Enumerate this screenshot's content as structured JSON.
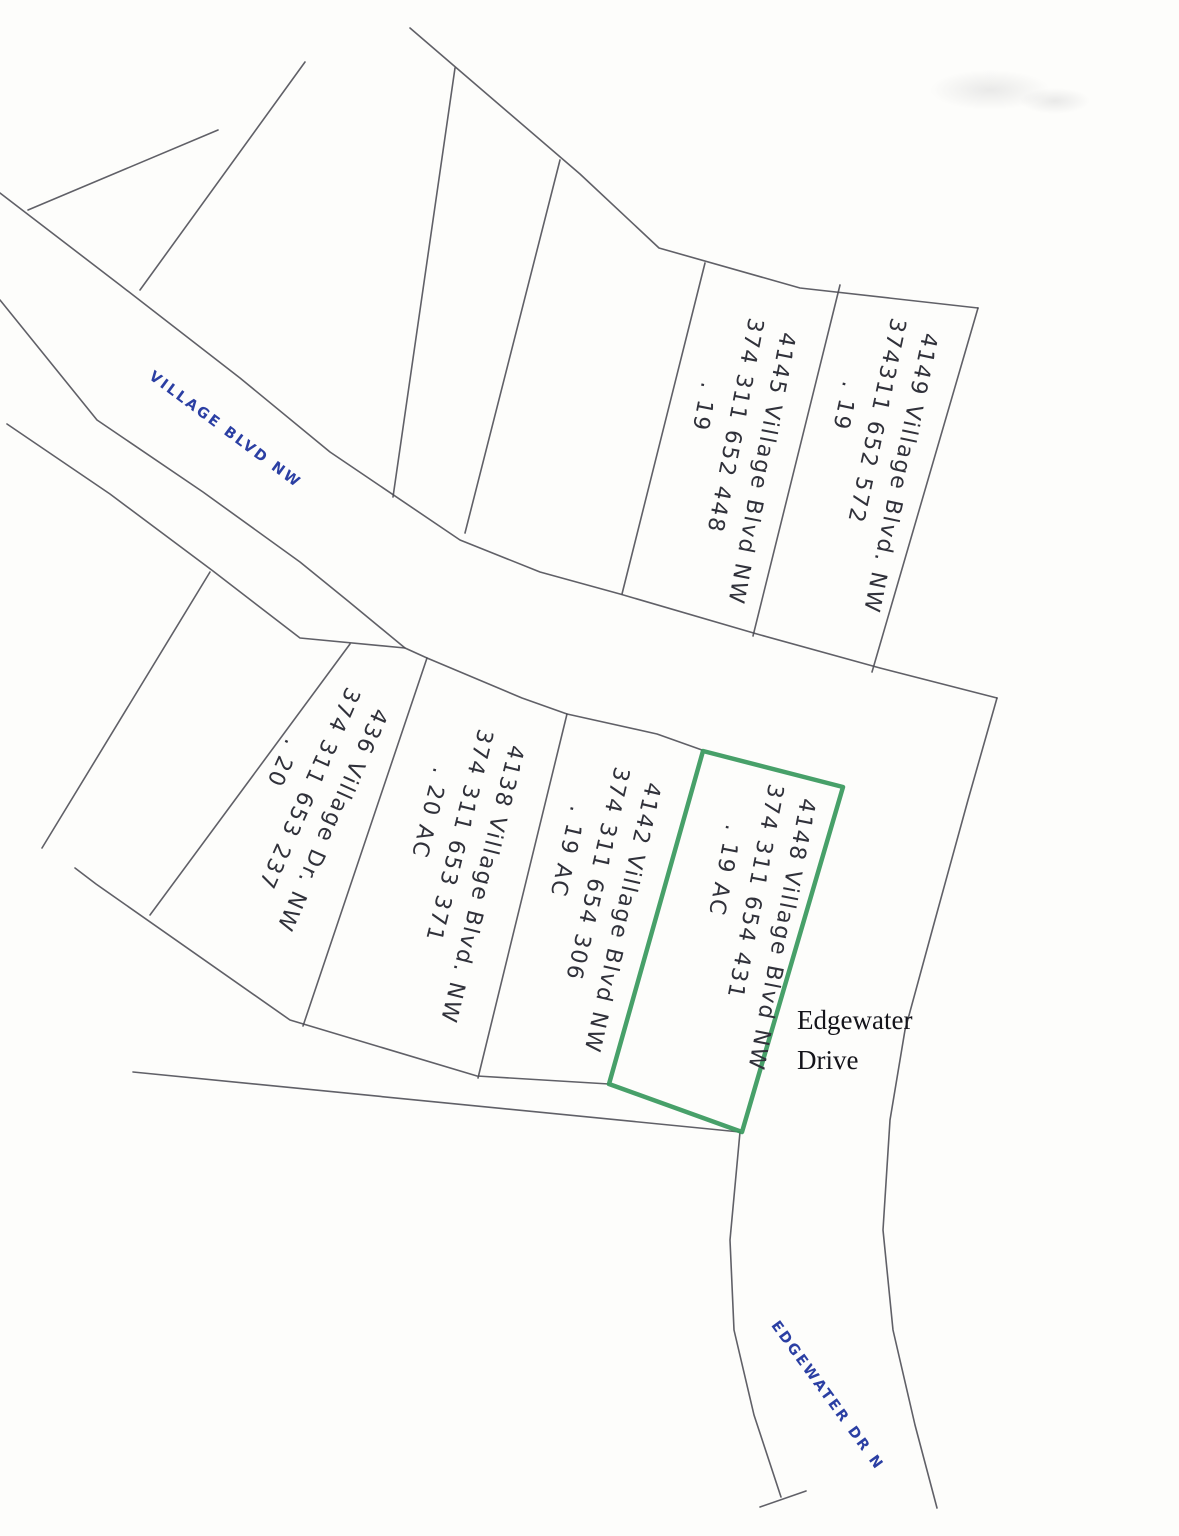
{
  "map": {
    "streets": [
      {
        "name": "VILLAGE BLVD NW"
      },
      {
        "name": "EDGEWATER DR N"
      }
    ],
    "area_label": {
      "line1": "Edgewater",
      "line2": "Drive"
    },
    "parcels": [
      {
        "address": "4149 Village Blvd. NW",
        "parcel_number": "374311 652 572",
        "acreage": ". 19",
        "highlighted": false
      },
      {
        "address": "4145 Village Blvd NW",
        "parcel_number": "374 311 652 448",
        "acreage": ". 19",
        "highlighted": false
      },
      {
        "address": "436 Village Dr. NW",
        "parcel_number": "374 311 653 237",
        "acreage": ". 20",
        "highlighted": false
      },
      {
        "address": "4138 Village Blvd. NW",
        "parcel_number": "374 311 653 371",
        "acreage": ". 20 AC",
        "highlighted": false
      },
      {
        "address": "4142 Village Blvd NW",
        "parcel_number": "374 311 654 306",
        "acreage": ". 19 AC",
        "highlighted": false
      },
      {
        "address": "4148 Village Blvd NW",
        "parcel_number": "374 311 654 431",
        "acreage": ". 19 AC",
        "highlighted": true
      }
    ],
    "colors": {
      "street_label": "#2b3fa3",
      "highlight_outline": "#37985c",
      "boundary_line": "#4a4a52",
      "handwriting_ink": "#30313a"
    }
  }
}
